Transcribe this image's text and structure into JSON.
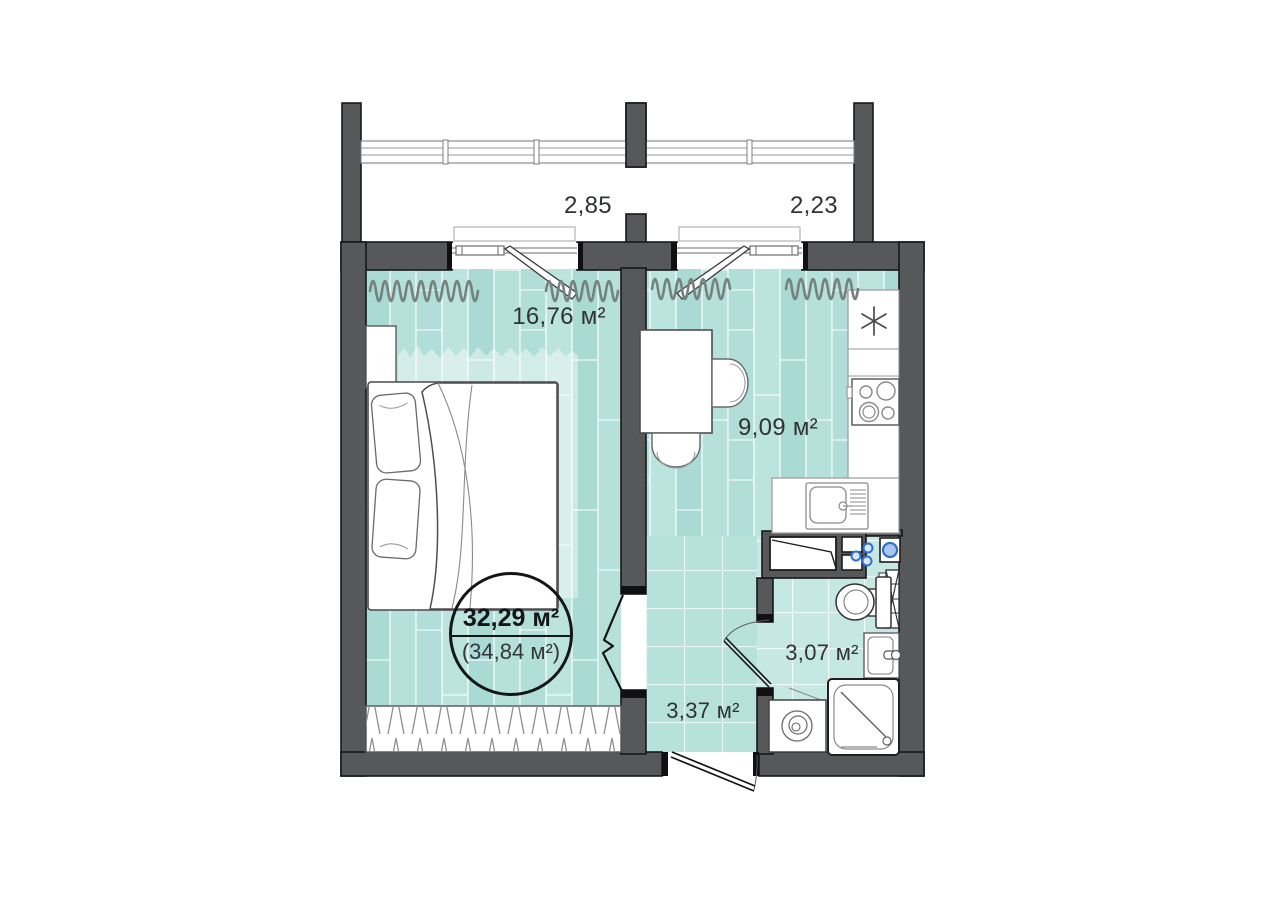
{
  "floor_plan": {
    "name": "one-room-apartment-plan",
    "total_area_label": "32,29 м²",
    "total_area_secondary_label": "(34,84 м²)",
    "balcony_sections": [
      {
        "name": "balcony-left",
        "width_label": "2,85"
      },
      {
        "name": "balcony-right",
        "width_label": "2,23"
      }
    ],
    "rooms": [
      {
        "name": "living-bedroom",
        "area_label": "16,76 м²"
      },
      {
        "name": "kitchen",
        "area_label": "9,09 м²"
      },
      {
        "name": "bathroom",
        "area_label": "3,07 м²"
      },
      {
        "name": "hallway",
        "area_label": "3,37 м²"
      }
    ],
    "colors": {
      "wall": "#57585a",
      "floor_plank_teal": "#b1ded8",
      "floor_tile_teal": "#c5e8e2",
      "hall_tile_teal": "#b7e2dc",
      "accent_blue": "#2f6fd0",
      "curtain_gray": "#75837f"
    }
  }
}
